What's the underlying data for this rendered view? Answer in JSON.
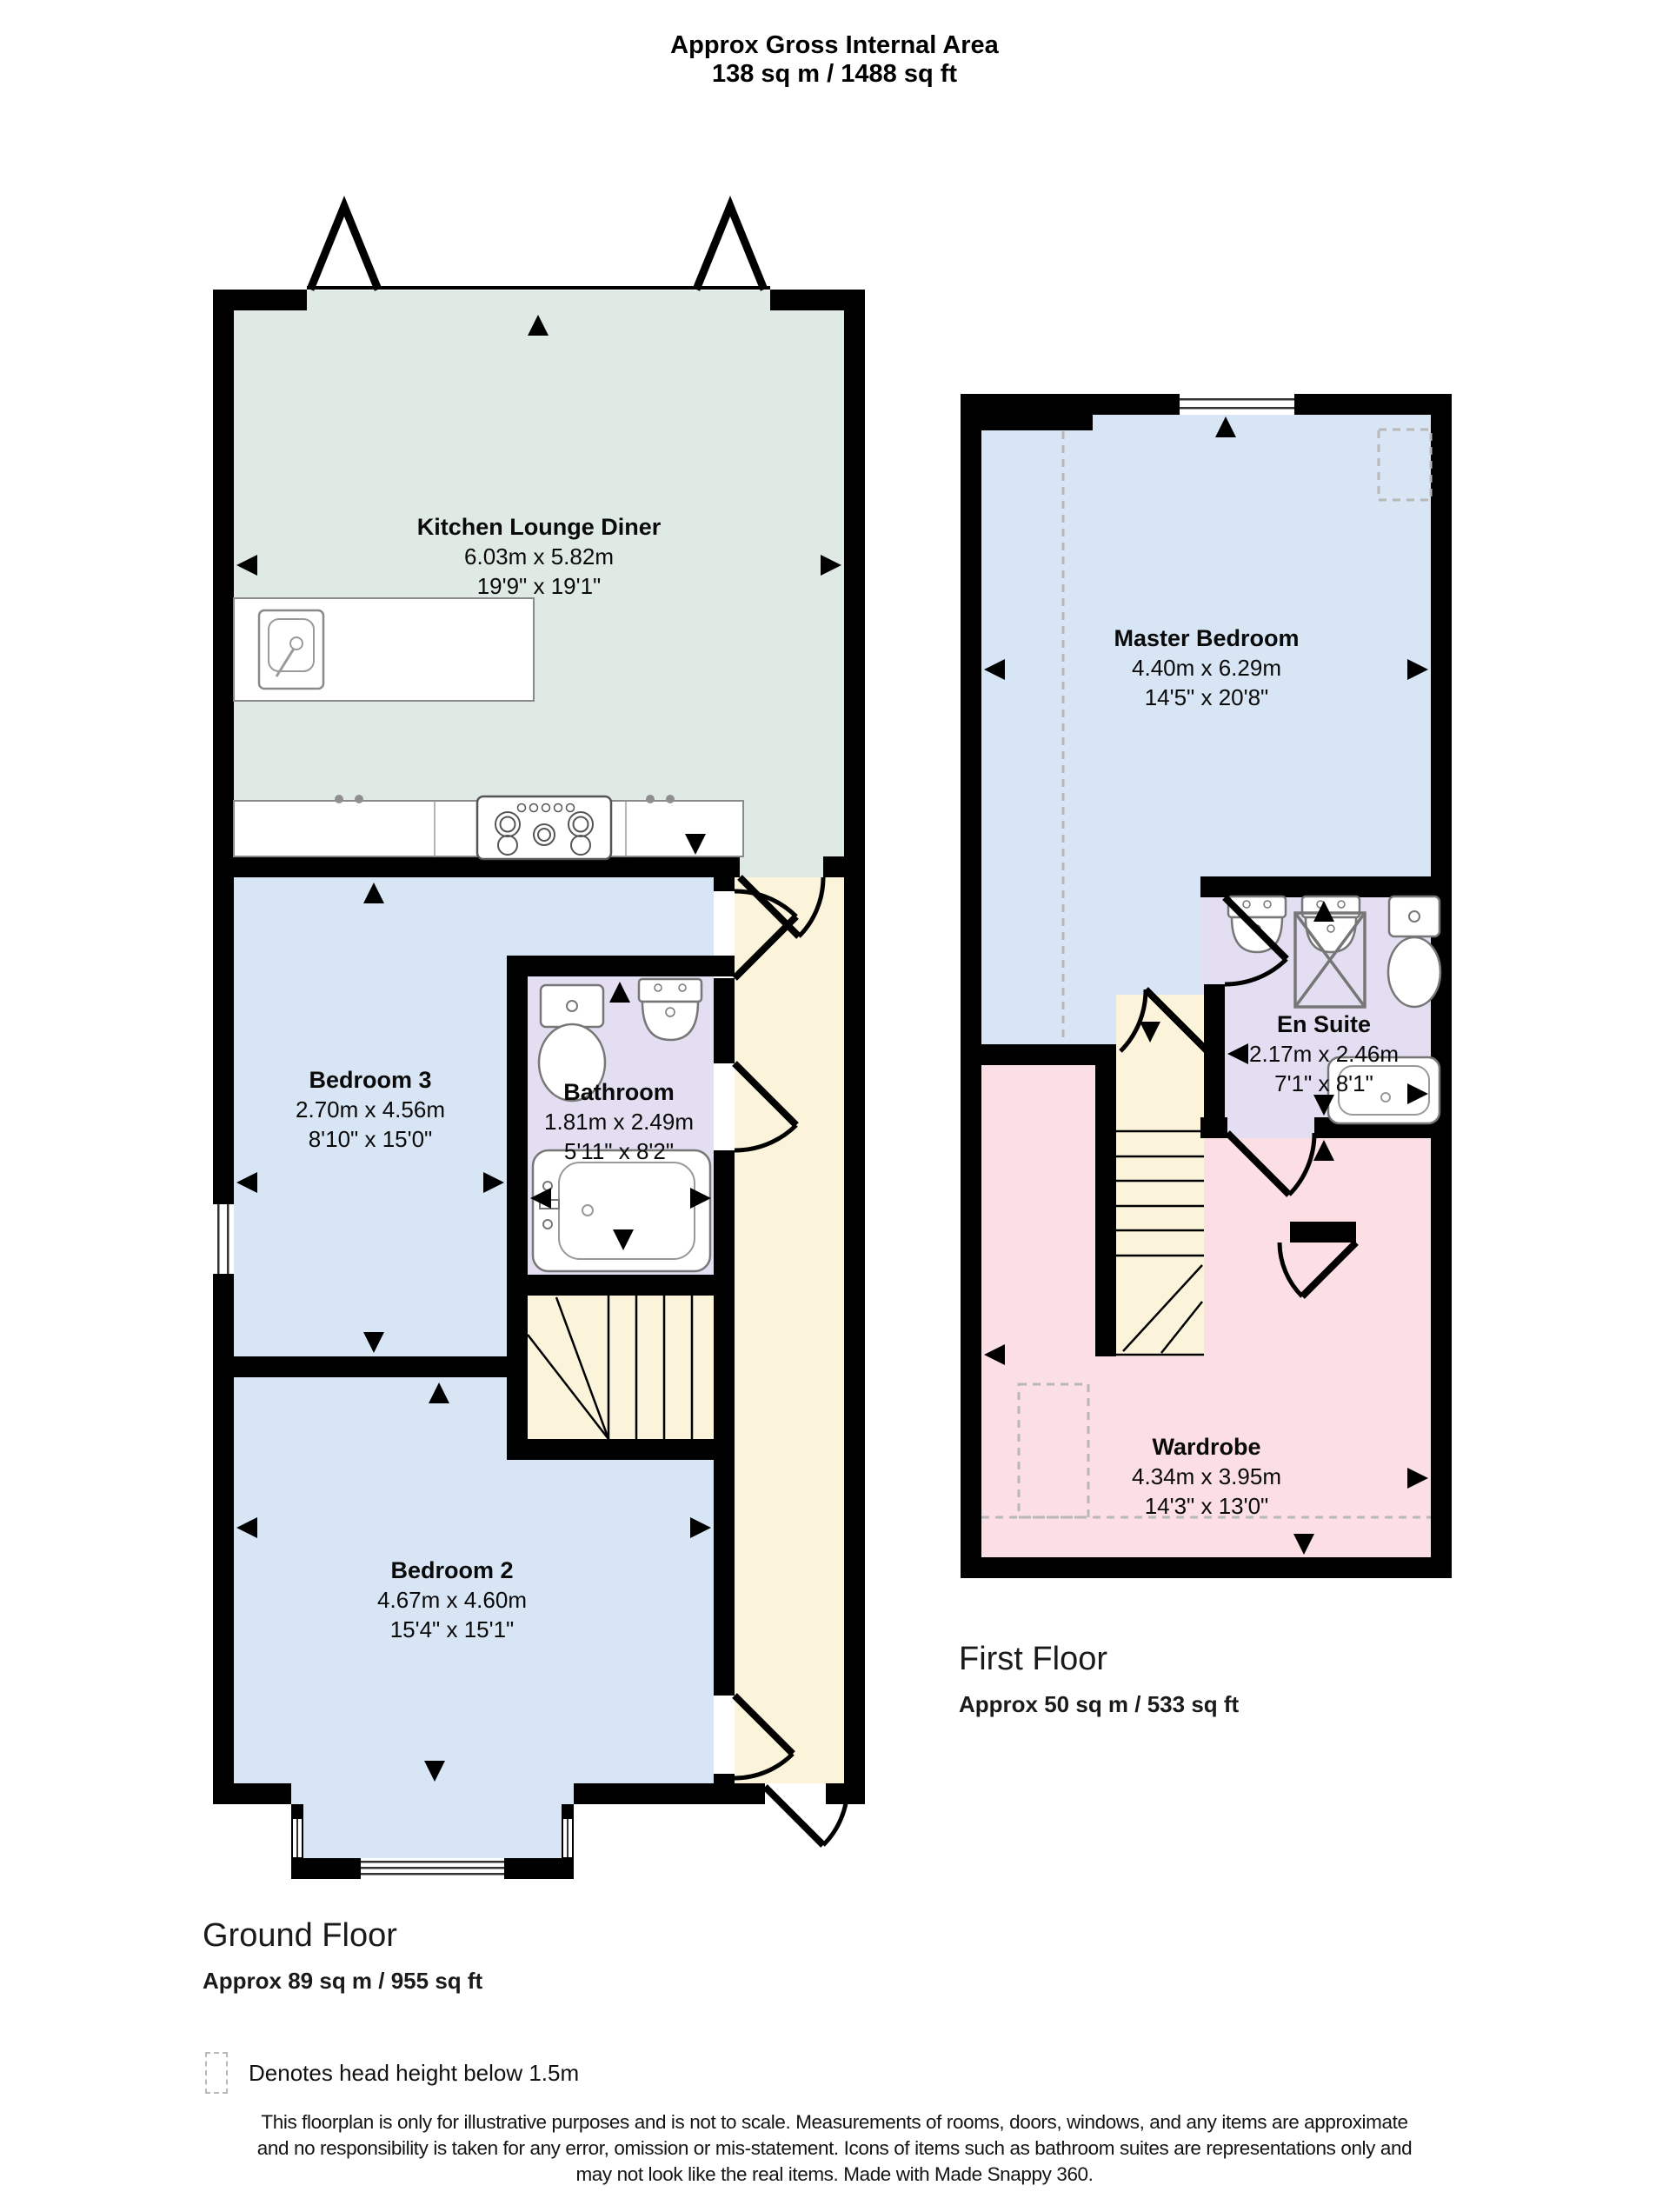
{
  "header": {
    "title": "Approx Gross Internal Area",
    "subtitle": "138 sq m / 1488 sq ft"
  },
  "ground_floor": {
    "name": "Ground Floor",
    "area": "Approx 89 sq m / 955 sq ft",
    "rooms": {
      "kitchen": {
        "name": "Kitchen Lounge Diner",
        "metric": "6.03m x 5.82m",
        "imperial": "19'9\" x 19'1\""
      },
      "bedroom3": {
        "name": "Bedroom 3",
        "metric": "2.70m x 4.56m",
        "imperial": "8'10\" x 15'0\""
      },
      "bathroom": {
        "name": "Bathroom",
        "metric": "1.81m x 2.49m",
        "imperial": "5'11\" x 8'2\""
      },
      "bedroom2": {
        "name": "Bedroom 2",
        "metric": "4.67m x 4.60m",
        "imperial": "15'4\" x 15'1\""
      }
    }
  },
  "first_floor": {
    "name": "First Floor",
    "area": "Approx 50 sq m / 533 sq ft",
    "rooms": {
      "master": {
        "name": "Master Bedroom",
        "metric": "4.40m x 6.29m",
        "imperial": "14'5\" x 20'8\""
      },
      "ensuite": {
        "name": "En Suite",
        "metric": "2.17m x 2.46m",
        "imperial": "7'1\" x 8'1\""
      },
      "wardrobe": {
        "name": "Wardrobe",
        "metric": "4.34m x 3.95m",
        "imperial": "14'3\" x 13'0\""
      }
    }
  },
  "legend": {
    "label": "Denotes head height below 1.5m"
  },
  "disclaimer": {
    "line1": "This floorplan is only for illustrative purposes and is not to scale. Measurements of rooms, doors, windows, and any items are approximate",
    "line2": "and no responsibility is taken for any error, omission or mis-statement. Icons of items such as bathroom suites are representations only and",
    "line3": "may not look like the real items. Made with Made Snappy 360."
  },
  "colors": {
    "kitchen": "#dfeae4",
    "bedroom": "#d7e5f4",
    "bathroom": "#e3def1",
    "hallway": "#fbf3da",
    "wardrobe": "#fbdfe4",
    "wall": "#000000",
    "dash": "#b8b8b8"
  }
}
